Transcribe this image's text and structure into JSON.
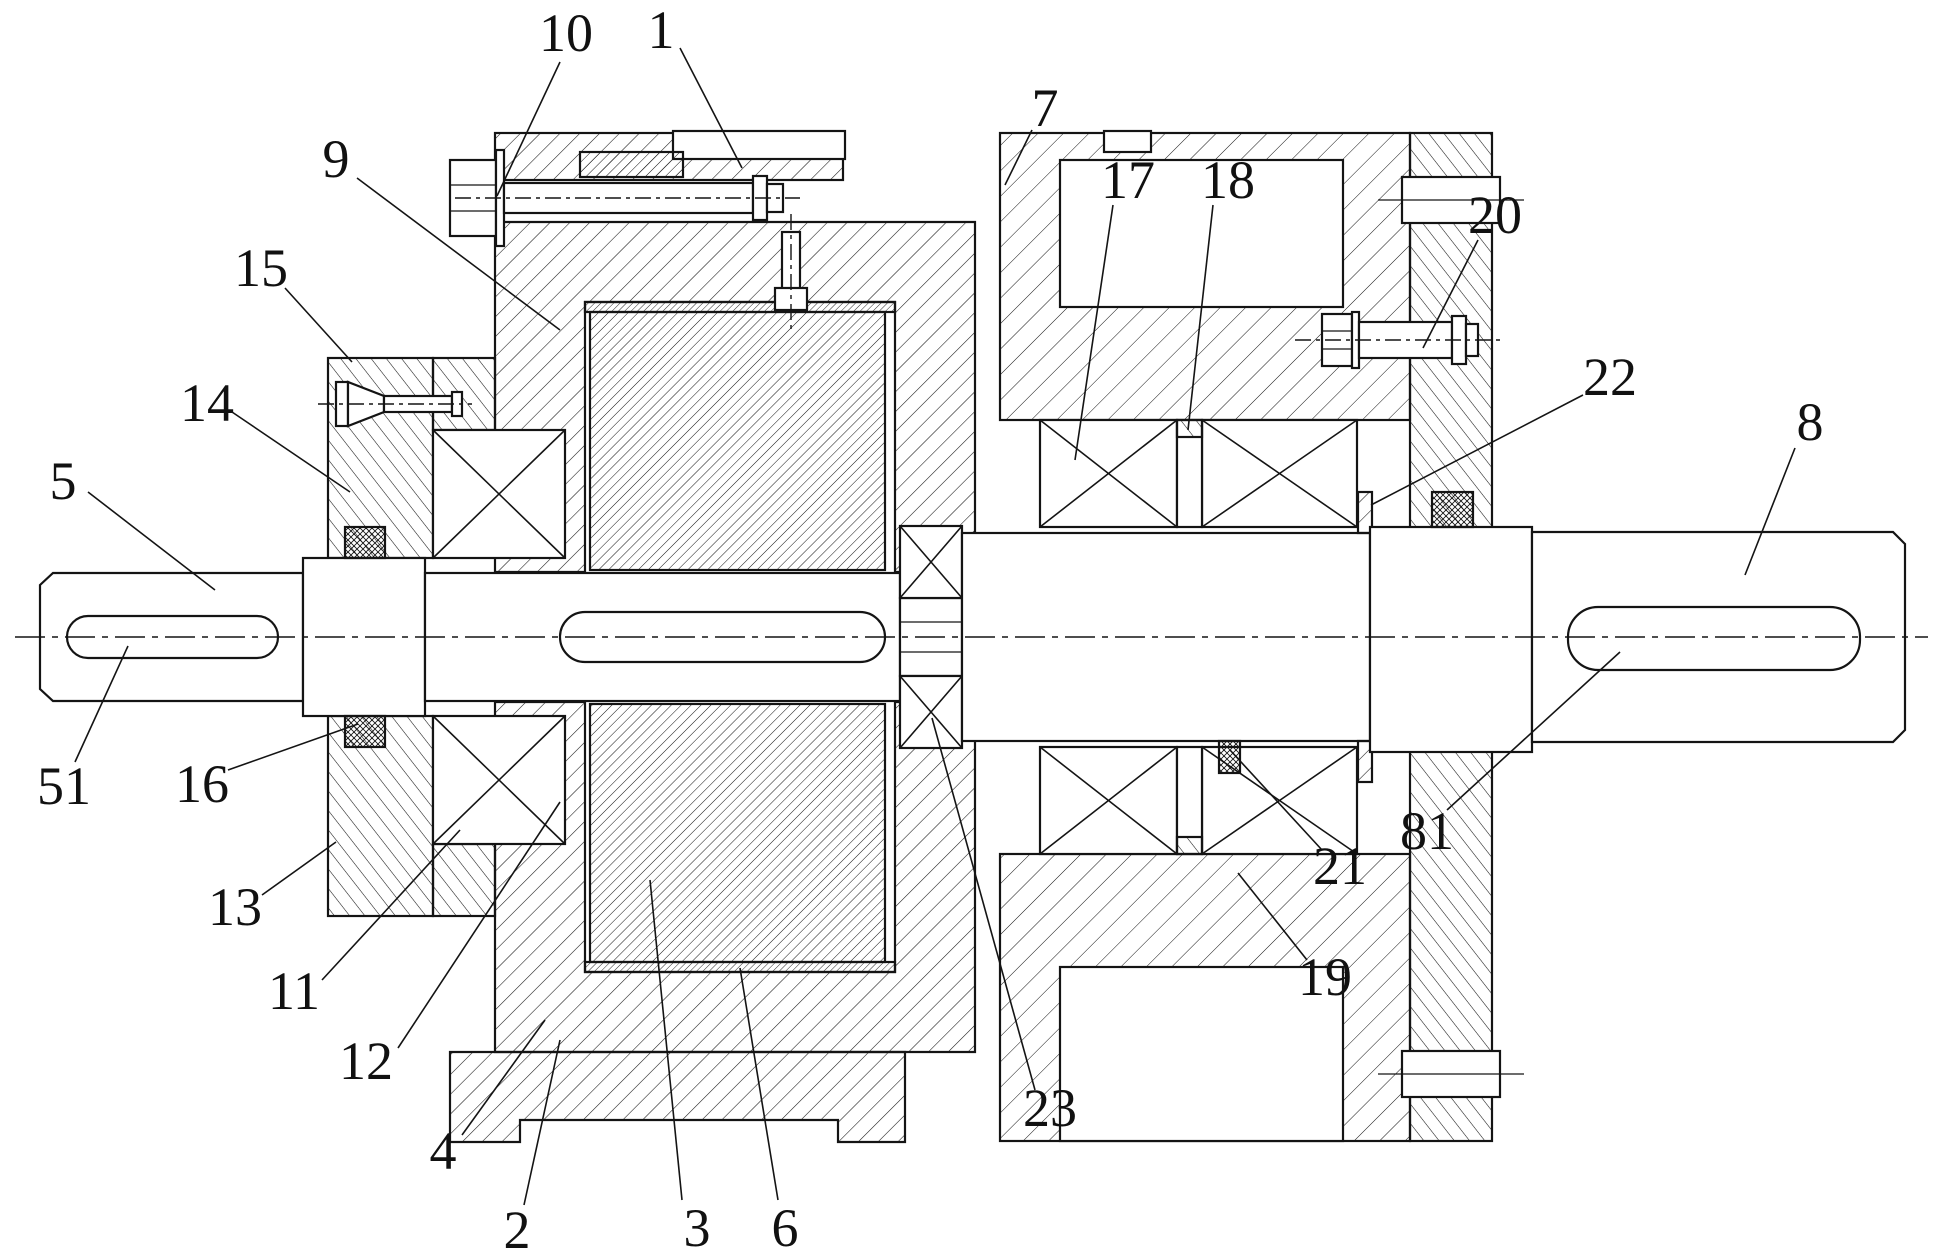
{
  "figure": {
    "kind": "mechanical-cross-section",
    "canvas": {
      "width": 1942,
      "height": 1260
    },
    "colors": {
      "ink": "#141414",
      "background": "#ffffff"
    },
    "axis": {
      "y": 637,
      "x1": 15,
      "x2": 1928
    },
    "callouts": [
      {
        "label": "10",
        "tx": 566,
        "ty": 33,
        "x1": 560,
        "y1": 62,
        "x2": 497,
        "y2": 196
      },
      {
        "label": "1",
        "tx": 661,
        "ty": 30,
        "x1": 680,
        "y1": 48,
        "x2": 742,
        "y2": 168
      },
      {
        "label": "7",
        "tx": 1045,
        "ty": 108,
        "x1": 1032,
        "y1": 130,
        "x2": 1005,
        "y2": 185
      },
      {
        "label": "17",
        "tx": 1128,
        "ty": 180,
        "x1": 1113,
        "y1": 205,
        "x2": 1075,
        "y2": 460
      },
      {
        "label": "18",
        "tx": 1228,
        "ty": 180,
        "x1": 1213,
        "y1": 205,
        "x2": 1188,
        "y2": 430
      },
      {
        "label": "20",
        "tx": 1495,
        "ty": 215,
        "x1": 1478,
        "y1": 240,
        "x2": 1423,
        "y2": 348
      },
      {
        "label": "9",
        "tx": 336,
        "ty": 159,
        "x1": 357,
        "y1": 178,
        "x2": 560,
        "y2": 330
      },
      {
        "label": "15",
        "tx": 261,
        "ty": 268,
        "x1": 285,
        "y1": 288,
        "x2": 352,
        "y2": 362
      },
      {
        "label": "14",
        "tx": 207,
        "ty": 403,
        "x1": 232,
        "y1": 412,
        "x2": 350,
        "y2": 492
      },
      {
        "label": "22",
        "tx": 1610,
        "ty": 377,
        "x1": 1583,
        "y1": 395,
        "x2": 1371,
        "y2": 505
      },
      {
        "label": "8",
        "tx": 1810,
        "ty": 422,
        "x1": 1795,
        "y1": 448,
        "x2": 1745,
        "y2": 575
      },
      {
        "label": "5",
        "tx": 63,
        "ty": 481,
        "x1": 88,
        "y1": 492,
        "x2": 215,
        "y2": 590
      },
      {
        "label": "51",
        "tx": 64,
        "ty": 786,
        "x1": 75,
        "y1": 762,
        "x2": 128,
        "y2": 646
      },
      {
        "label": "16",
        "tx": 202,
        "ty": 784,
        "x1": 228,
        "y1": 770,
        "x2": 358,
        "y2": 724
      },
      {
        "label": "13",
        "tx": 235,
        "ty": 907,
        "x1": 262,
        "y1": 895,
        "x2": 336,
        "y2": 842
      },
      {
        "label": "11",
        "tx": 294,
        "ty": 991,
        "x1": 322,
        "y1": 980,
        "x2": 460,
        "y2": 830
      },
      {
        "label": "12",
        "tx": 366,
        "ty": 1061,
        "x1": 398,
        "y1": 1048,
        "x2": 560,
        "y2": 802
      },
      {
        "label": "4",
        "tx": 443,
        "ty": 1151,
        "x1": 462,
        "y1": 1135,
        "x2": 545,
        "y2": 1020
      },
      {
        "label": "2",
        "tx": 517,
        "ty": 1230,
        "x1": 524,
        "y1": 1205,
        "x2": 560,
        "y2": 1040
      },
      {
        "label": "3",
        "tx": 697,
        "ty": 1228,
        "x1": 682,
        "y1": 1200,
        "x2": 650,
        "y2": 880
      },
      {
        "label": "6",
        "tx": 785,
        "ty": 1228,
        "x1": 778,
        "y1": 1200,
        "x2": 740,
        "y2": 968
      },
      {
        "label": "23",
        "tx": 1050,
        "ty": 1108,
        "x1": 1035,
        "y1": 1090,
        "x2": 932,
        "y2": 718
      },
      {
        "label": "19",
        "tx": 1325,
        "ty": 977,
        "x1": 1307,
        "y1": 960,
        "x2": 1238,
        "y2": 873
      },
      {
        "label": "21",
        "tx": 1340,
        "ty": 866,
        "x1": 1322,
        "y1": 850,
        "x2": 1230,
        "y2": 750
      },
      {
        "label": "81",
        "tx": 1427,
        "ty": 831,
        "x1": 1447,
        "y1": 810,
        "x2": 1620,
        "y2": 652
      }
    ]
  }
}
